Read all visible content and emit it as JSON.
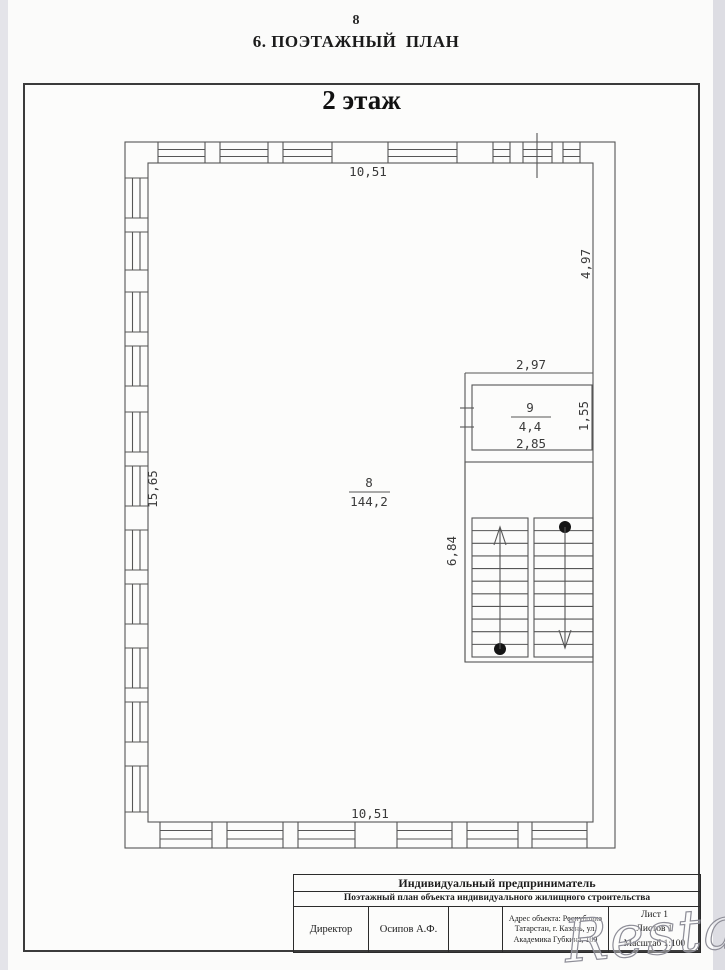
{
  "page": {
    "page_number": "8",
    "section_title": "6. ПОЭТАЖНЫЙ  ПЛАН",
    "floor_title": "2 этаж"
  },
  "plan": {
    "dimensions": {
      "top_width": "10,51",
      "bottom_width": "10,51",
      "left_height": "15,65",
      "right_height": "4,97",
      "stair_height": "6,84",
      "room9_top_width": "2,97",
      "room9_bottom_width": "2,85",
      "room9_height": "1,55"
    },
    "rooms": [
      {
        "number": "8",
        "area": "144,2"
      },
      {
        "number": "9",
        "area": "4,4"
      }
    ]
  },
  "title_block": {
    "organization": "Индивидуальный предприниматель",
    "document_title": "Поэтажный план объекта индивидуального жилищного строительства",
    "role": "Директор",
    "name": "Осипов А.Ф.",
    "address_line1": "Адрес объекта: Республика",
    "address_line2": "Татарстан, г. Казань, ул.",
    "address_line3": "Академика Губкина, 109",
    "sheet": "Лист 1",
    "sheets_total": "Листов 1",
    "scale": "Масштаб 1:100"
  },
  "watermark": "Restate"
}
